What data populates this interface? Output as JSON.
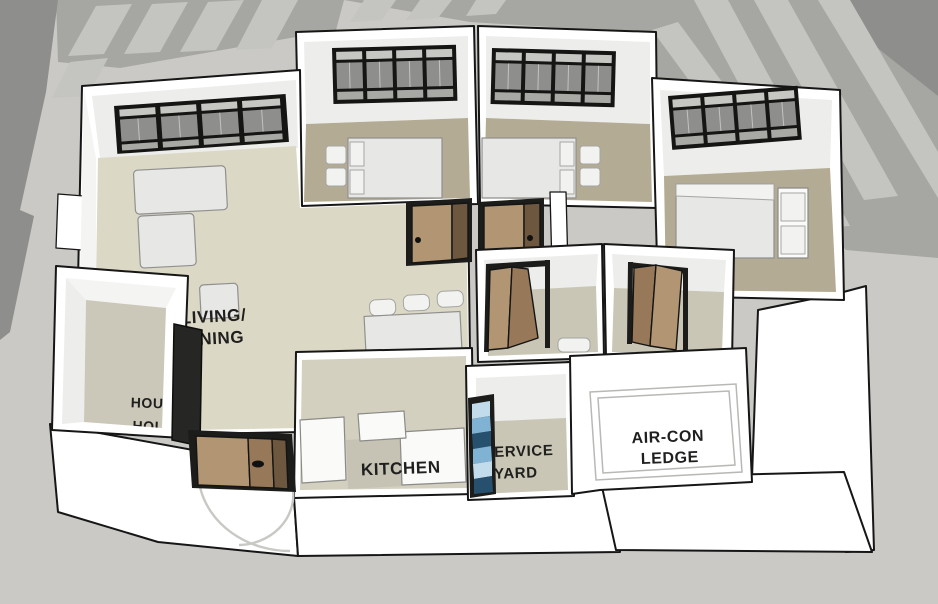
{
  "labels": {
    "living_dining": {
      "line1": "LIVING/",
      "line2": "DINING"
    },
    "kitchen": {
      "line1": "KITCHEN"
    },
    "service_yard": {
      "line1": "ERVICE",
      "line2": "YARD"
    },
    "aircon_ledge": {
      "line1": "AIR-CON",
      "line2": "LEDGE"
    },
    "household_shelter": {
      "line1": "HOUS",
      "line2": "HOL"
    },
    "bathroom_partial": {
      "line1": "AI",
      "line2": "ED"
    },
    "aircon_window": {
      "line1": "C"
    }
  },
  "palette": {
    "bg": "#cac9c5",
    "shadow_mid": "#a6a6a3",
    "shadow_dark": "#8e8e8c",
    "shadow_stripe": "#c4c4c1",
    "wall_white": "#ffffff",
    "wall_face": "#ededeb",
    "outline": "#161616",
    "floor_living": "#dcd8c6",
    "floor_bedroom": "#b3ab93",
    "floor_bath": "#c9c6b5",
    "floor_kitchen": "#d4d0bf",
    "floor_shelter": "#cbc8ba",
    "floor_service": "#c9c6b6",
    "glass_top": "#c6c6c3",
    "glass_mid": "#8e8e8c",
    "glass_bottom": "#a8a8a5",
    "wood_light": "#b29572",
    "wood_mid": "#97795a",
    "wood_dark": "#6e573f",
    "louvre_dark": "#27506e",
    "louvre_mid": "#7fb2d3",
    "louvre_light": "#c3dcec",
    "furniture": "#e7e7e5",
    "furniture_light": "#f2f2f0",
    "text": "#1f1f1d",
    "text_faint": "#8c8c84"
  }
}
